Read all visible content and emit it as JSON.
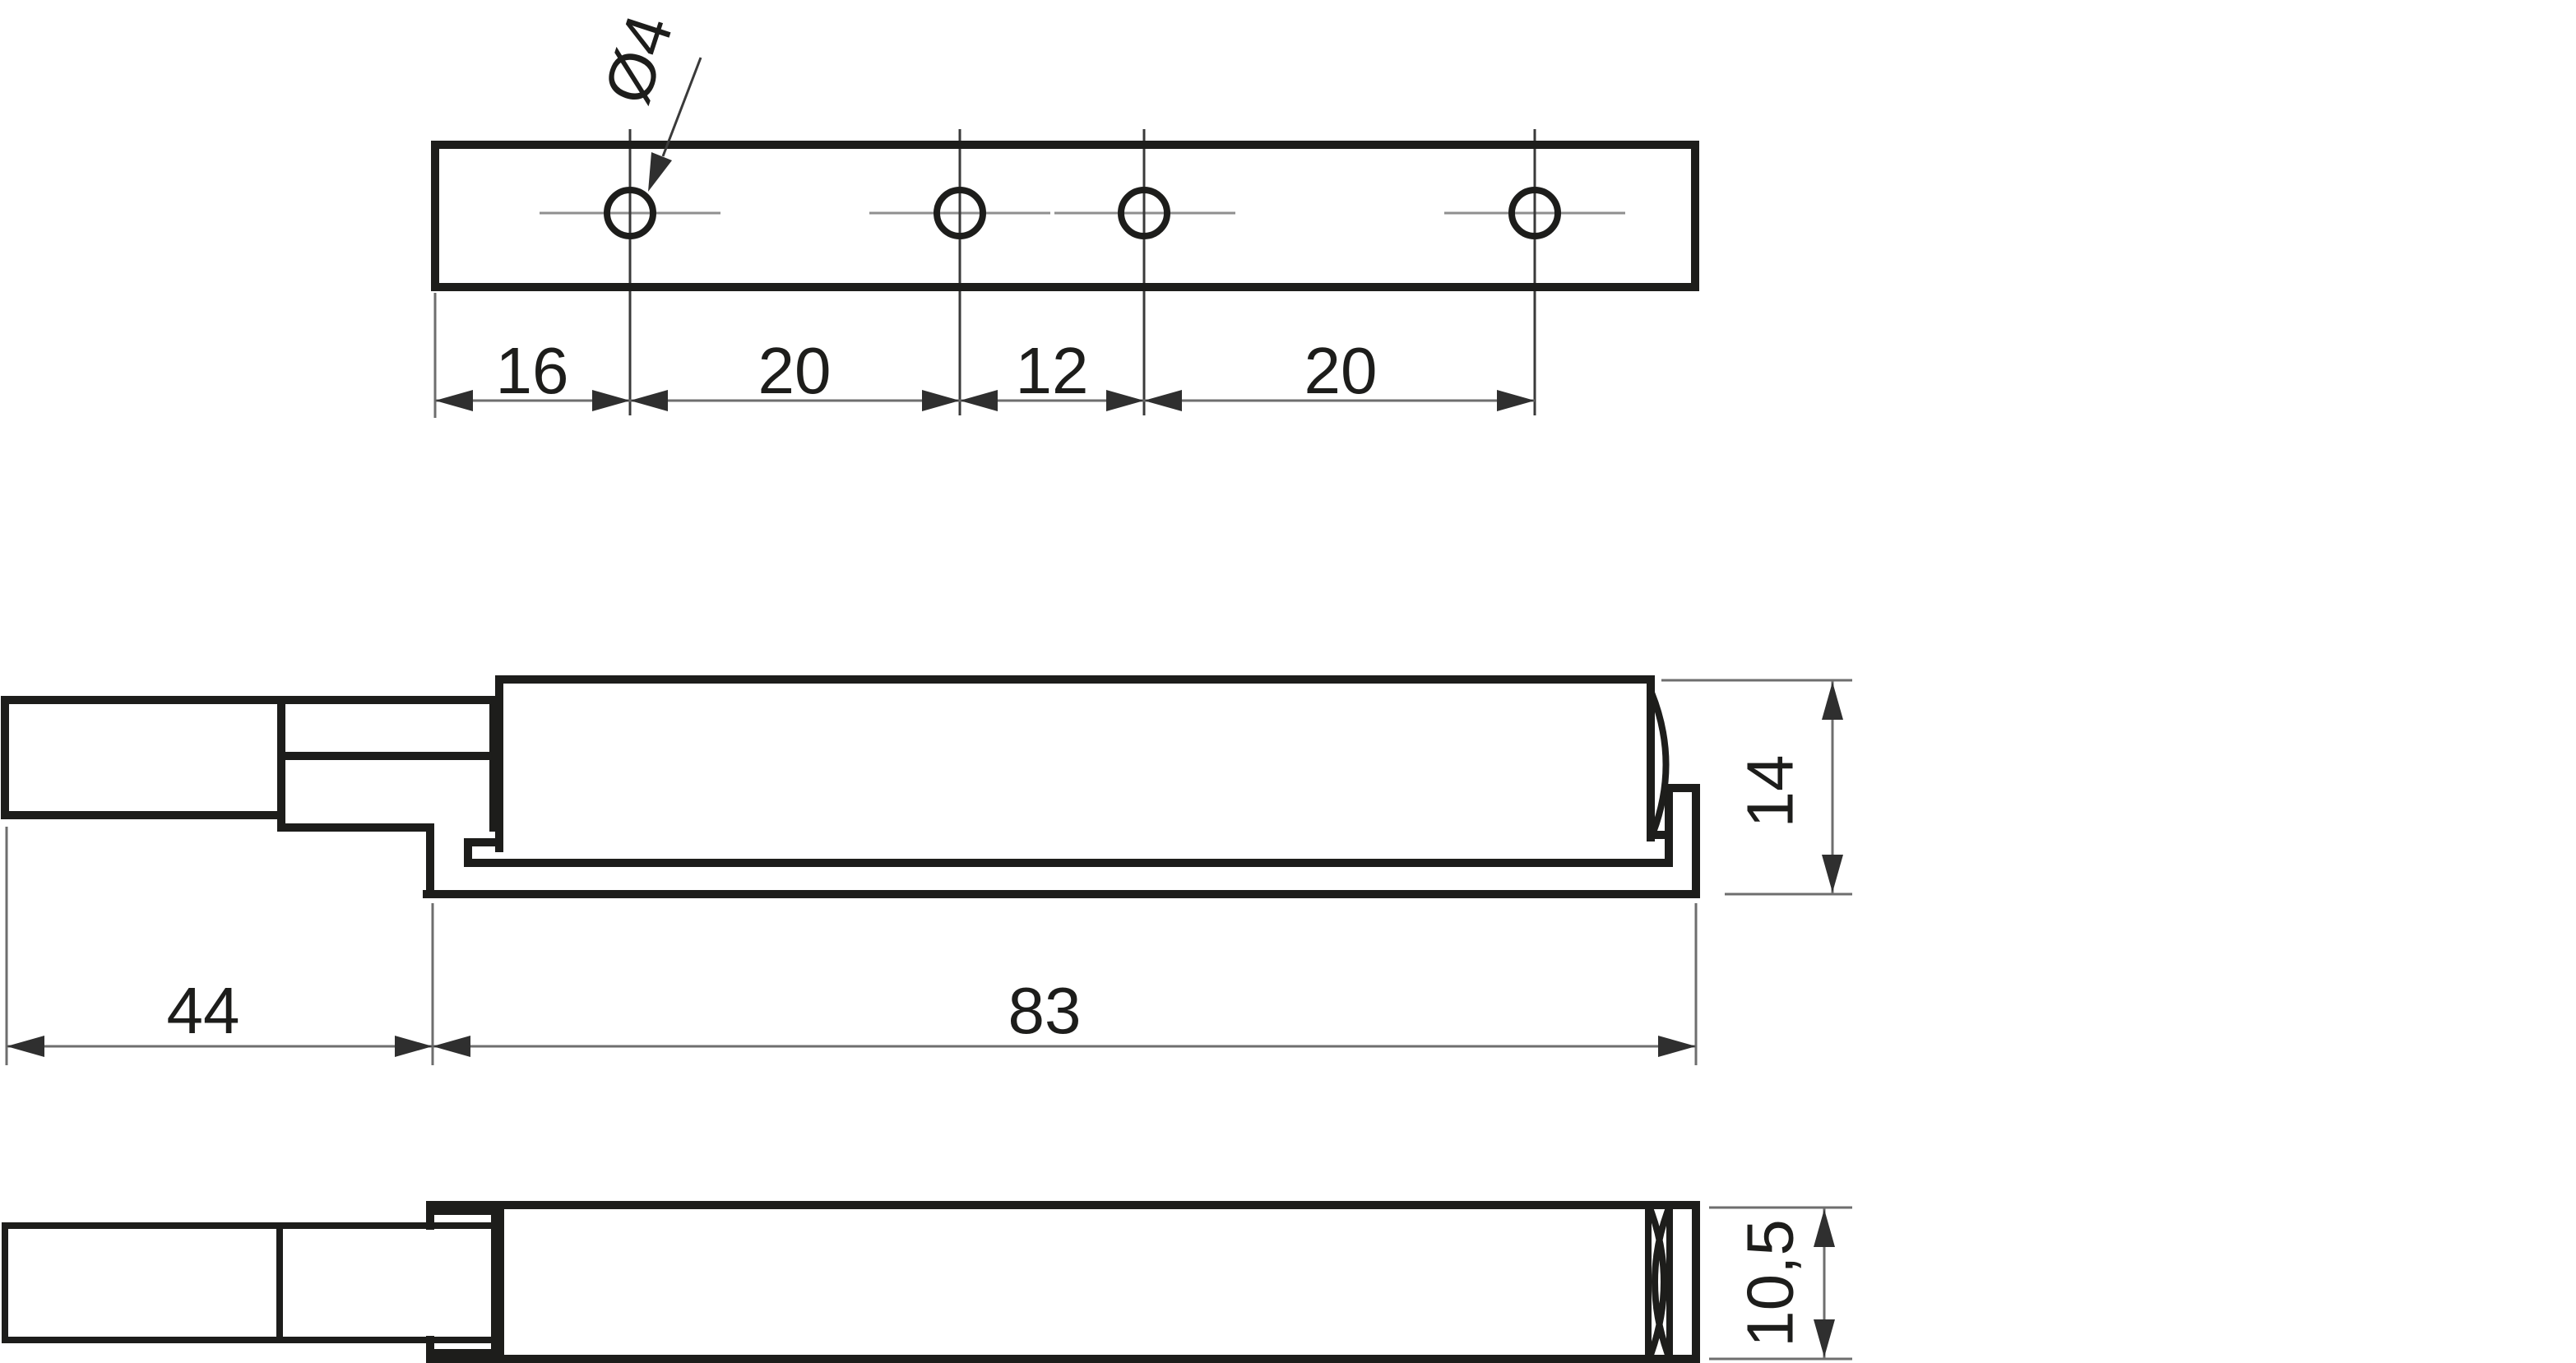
{
  "drawing": {
    "type": "technical-drawing",
    "views": {
      "top_view": {
        "hole_diameter_label": "Ø4",
        "dim_labels": [
          "16",
          "20",
          "12",
          "20"
        ]
      },
      "side_view": {
        "plunger_length_label": "44",
        "body_length_label": "83",
        "height_label": "14"
      },
      "bottom_view": {
        "height_label": "10,5"
      }
    },
    "colors": {
      "background": "#ffffff",
      "outline": "#1d1d1b",
      "dimension_line": "#6e6e6e",
      "centerline": "#8f8f8f",
      "arrow": "#2f2f2f"
    }
  }
}
